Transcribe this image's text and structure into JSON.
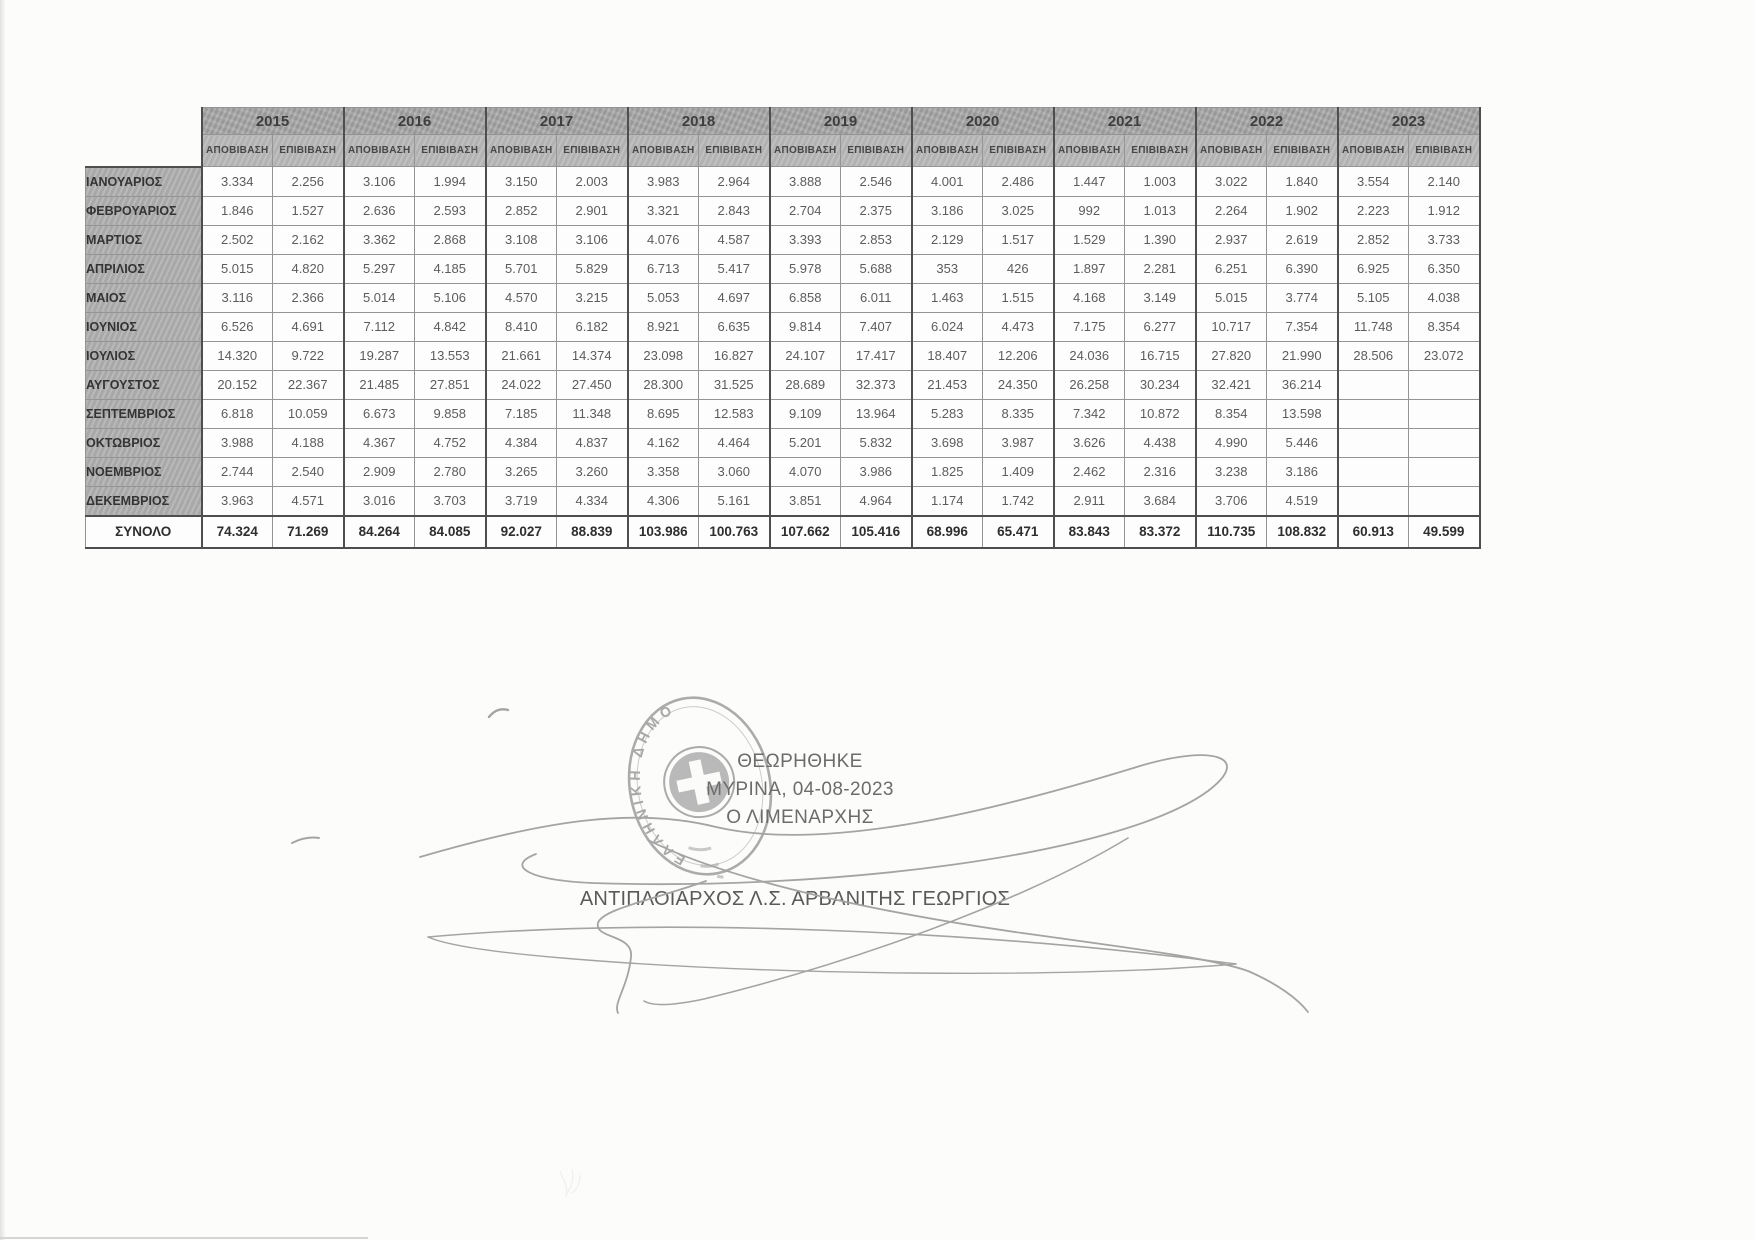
{
  "table": {
    "years": [
      "2015",
      "2016",
      "2017",
      "2018",
      "2019",
      "2020",
      "2021",
      "2022",
      "2023"
    ],
    "sub_columns": [
      "ΑΠΟΒΙΒΑΣΗ",
      "ΕΠΙΒΙΒΑΣΗ"
    ],
    "rows": [
      {
        "month": "ΙΑΝΟΥΑΡΙΟΣ",
        "values": [
          "3.334",
          "2.256",
          "3.106",
          "1.994",
          "3.150",
          "2.003",
          "3.983",
          "2.964",
          "3.888",
          "2.546",
          "4.001",
          "2.486",
          "1.447",
          "1.003",
          "3.022",
          "1.840",
          "3.554",
          "2.140"
        ]
      },
      {
        "month": "ΦΕΒΡΟΥΑΡΙΟΣ",
        "values": [
          "1.846",
          "1.527",
          "2.636",
          "2.593",
          "2.852",
          "2.901",
          "3.321",
          "2.843",
          "2.704",
          "2.375",
          "3.186",
          "3.025",
          "992",
          "1.013",
          "2.264",
          "1.902",
          "2.223",
          "1.912"
        ]
      },
      {
        "month": "ΜΑΡΤΙΟΣ",
        "values": [
          "2.502",
          "2.162",
          "3.362",
          "2.868",
          "3.108",
          "3.106",
          "4.076",
          "4.587",
          "3.393",
          "2.853",
          "2.129",
          "1.517",
          "1.529",
          "1.390",
          "2.937",
          "2.619",
          "2.852",
          "3.733"
        ]
      },
      {
        "month": "ΑΠΡΙΛΙΟΣ",
        "values": [
          "5.015",
          "4.820",
          "5.297",
          "4.185",
          "5.701",
          "5.829",
          "6.713",
          "5.417",
          "5.978",
          "5.688",
          "353",
          "426",
          "1.897",
          "2.281",
          "6.251",
          "6.390",
          "6.925",
          "6.350"
        ]
      },
      {
        "month": "ΜΑΙΟΣ",
        "values": [
          "3.116",
          "2.366",
          "5.014",
          "5.106",
          "4.570",
          "3.215",
          "5.053",
          "4.697",
          "6.858",
          "6.011",
          "1.463",
          "1.515",
          "4.168",
          "3.149",
          "5.015",
          "3.774",
          "5.105",
          "4.038"
        ]
      },
      {
        "month": "ΙΟΥΝΙΟΣ",
        "values": [
          "6.526",
          "4.691",
          "7.112",
          "4.842",
          "8.410",
          "6.182",
          "8.921",
          "6.635",
          "9.814",
          "7.407",
          "6.024",
          "4.473",
          "7.175",
          "6.277",
          "10.717",
          "7.354",
          "11.748",
          "8.354"
        ]
      },
      {
        "month": "ΙΟΥΛΙΟΣ",
        "values": [
          "14.320",
          "9.722",
          "19.287",
          "13.553",
          "21.661",
          "14.374",
          "23.098",
          "16.827",
          "24.107",
          "17.417",
          "18.407",
          "12.206",
          "24.036",
          "16.715",
          "27.820",
          "21.990",
          "28.506",
          "23.072"
        ]
      },
      {
        "month": "ΑΥΓΟΥΣΤΟΣ",
        "values": [
          "20.152",
          "22.367",
          "21.485",
          "27.851",
          "24.022",
          "27.450",
          "28.300",
          "31.525",
          "28.689",
          "32.373",
          "21.453",
          "24.350",
          "26.258",
          "30.234",
          "32.421",
          "36.214",
          "",
          ""
        ]
      },
      {
        "month": "ΣΕΠΤΕΜΒΡΙΟΣ",
        "values": [
          "6.818",
          "10.059",
          "6.673",
          "9.858",
          "7.185",
          "11.348",
          "8.695",
          "12.583",
          "9.109",
          "13.964",
          "5.283",
          "8.335",
          "7.342",
          "10.872",
          "8.354",
          "13.598",
          "",
          ""
        ]
      },
      {
        "month": "ΟΚΤΩΒΡΙΟΣ",
        "values": [
          "3.988",
          "4.188",
          "4.367",
          "4.752",
          "4.384",
          "4.837",
          "4.162",
          "4.464",
          "5.201",
          "5.832",
          "3.698",
          "3.987",
          "3.626",
          "4.438",
          "4.990",
          "5.446",
          "",
          ""
        ]
      },
      {
        "month": "ΝΟΕΜΒΡΙΟΣ",
        "values": [
          "2.744",
          "2.540",
          "2.909",
          "2.780",
          "3.265",
          "3.260",
          "3.358",
          "3.060",
          "4.070",
          "3.986",
          "1.825",
          "1.409",
          "2.462",
          "2.316",
          "3.238",
          "3.186",
          "",
          ""
        ]
      },
      {
        "month": "ΔΕΚΕΜΒΡΙΟΣ",
        "values": [
          "3.963",
          "4.571",
          "3.016",
          "3.703",
          "3.719",
          "4.334",
          "4.306",
          "5.161",
          "3.851",
          "4.964",
          "1.174",
          "1.742",
          "2.911",
          "3.684",
          "3.706",
          "4.519",
          "",
          ""
        ]
      }
    ],
    "total": {
      "label": "ΣΥΝΟΛΟ",
      "values": [
        "74.324",
        "71.269",
        "84.264",
        "84.085",
        "92.027",
        "88.839",
        "103.986",
        "100.763",
        "107.662",
        "105.416",
        "68.996",
        "65.471",
        "83.843",
        "83.372",
        "110.735",
        "108.832",
        "60.913",
        "49.599"
      ]
    }
  },
  "approval": {
    "line1": "ΘΕΩΡΗΘΗΚΕ",
    "line2": "ΜΥΡΙΝΑ, 04-08-2023",
    "line3": "Ο ΛΙΜΕΝΑΡΧΗΣ",
    "signatory": "ΑΝΤΙΠΛΟΙΑΡΧΟΣ Λ.Σ. ΑΡΒΑΝΙΤΗΣ ΓΕΩΡΓΙΟΣ"
  },
  "stamp": {
    "ring_text": "ΕΛΛΗΝΙΚΗ ΔΗΜΟΚΡΑΤΙΑ"
  },
  "colors": {
    "header_bg": "#a7a7a7",
    "subheader_bg": "#b9b9b9",
    "month_bg": "#b1b1b1",
    "border_dark": "#4e4e4e",
    "ink": "#5c5c5c",
    "stamp_ink": "#8d8d8d"
  }
}
